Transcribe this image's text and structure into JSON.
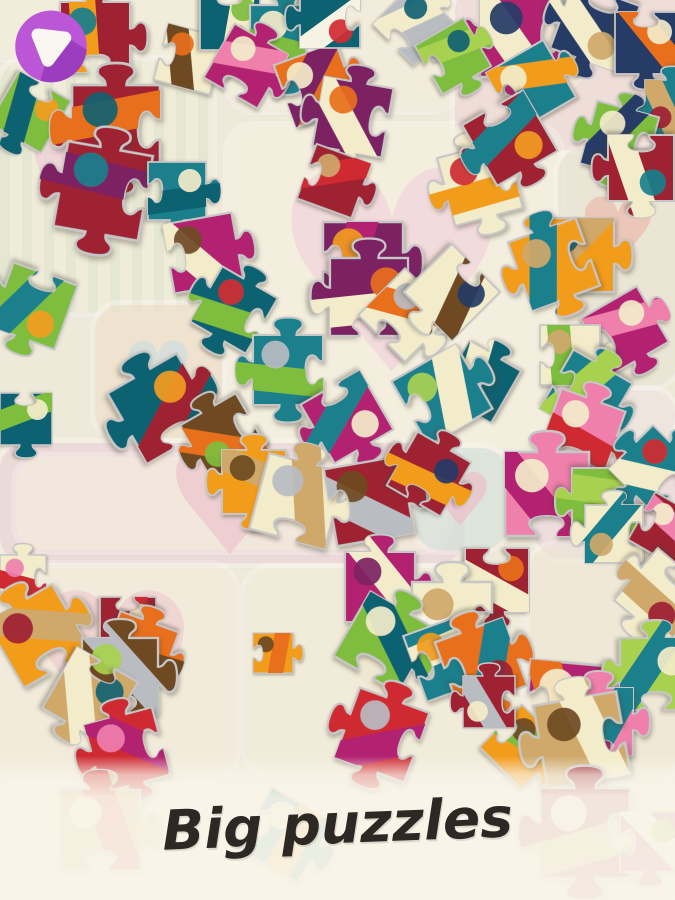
{
  "app": {
    "kind": "jigsaw-puzzle-game-screen"
  },
  "logo": {
    "name": "puzzle-app-logo",
    "glyph": "rounded-triangle-down",
    "circle_color": "#bb57d6",
    "shadow_color": "#9c3dc0",
    "glyph_color": "#faf7f2"
  },
  "banner": {
    "title": "Big puzzles",
    "bg_color": "#f9f5e9",
    "text_color": "#2d2823"
  },
  "scene": {
    "base_color": "#efe9da",
    "palette": {
      "teal": "#1a7f8c",
      "darkteal": "#116272",
      "magenta": "#b32470",
      "purple": "#7c2362",
      "darkred": "#9e2033",
      "red": "#cf2b32",
      "orange": "#f29c1f",
      "tangerine": "#e86f1a",
      "cream": "#f3ecca",
      "tan": "#cfa86a",
      "brown": "#6e4a23",
      "green": "#7ebd3d",
      "lime": "#a8d14f",
      "navy": "#253a66",
      "pink": "#ef7fab",
      "gray": "#b9bcc1",
      "white": "#f6f3e4"
    },
    "panels": [
      {
        "x": -20,
        "y": -20,
        "w": 260,
        "h": 78,
        "bg": "#f6efdc"
      },
      {
        "x": 0,
        "y": 60,
        "w": 212,
        "h": 252,
        "bg": "#f1f0da",
        "stripes": true,
        "hx": 78,
        "hy": 185,
        "hs": 120,
        "hc": "#f2c9d8"
      },
      {
        "x": 228,
        "y": -12,
        "w": 230,
        "h": 122,
        "bg": "#f5efdf"
      },
      {
        "x": 455,
        "y": -15,
        "w": 230,
        "h": 165,
        "bg": "#efd5d8",
        "hx": 560,
        "hy": 72,
        "hs": 120,
        "hc": "#f6efdd"
      },
      {
        "x": 228,
        "y": 126,
        "w": 332,
        "h": 322,
        "bg": "#f7f3e2",
        "hx": 392,
        "hy": 292,
        "hs": 280,
        "hc": "#f2d0dc"
      },
      {
        "x": 558,
        "y": 148,
        "w": 120,
        "h": 238,
        "bg": "#e8e2d1",
        "hx": 618,
        "hy": 238,
        "hs": 92,
        "hc": "#eab4a6"
      },
      {
        "x": 95,
        "y": 305,
        "w": 127,
        "h": 133,
        "bg": "#efdfc7",
        "hx": 158,
        "hy": 378,
        "hs": 82,
        "hc": "#cadde2"
      },
      {
        "x": 0,
        "y": 443,
        "w": 465,
        "h": 120,
        "bg": "#ebcfd9"
      },
      {
        "x": 16,
        "y": 457,
        "w": 432,
        "h": 93,
        "bg": "#f8f3e0",
        "hx": 230,
        "hy": 512,
        "hs": 150,
        "hc": "#edbfca"
      },
      {
        "x": 415,
        "y": 448,
        "w": 92,
        "h": 102,
        "bg": "#cfe2dc",
        "hx": 460,
        "hy": 505,
        "hs": 74,
        "hc": "#f0b9c6"
      },
      {
        "x": 535,
        "y": 436,
        "w": 140,
        "h": 122,
        "bg": "#ecd4de",
        "hx": 605,
        "hy": 502,
        "hs": 86,
        "hc": "#f6f2e6"
      },
      {
        "x": 558,
        "y": 390,
        "w": 117,
        "h": 50,
        "bg": "#f0e2e4"
      },
      {
        "x": -12,
        "y": 565,
        "w": 247,
        "h": 215,
        "bg": "#f6eedd",
        "hx": 112,
        "hy": 680,
        "hs": 200,
        "hc": "#eec9cf"
      },
      {
        "x": 245,
        "y": 568,
        "w": 275,
        "h": 205,
        "bg": "#f4eedb",
        "hx": 382,
        "hy": 672,
        "hs": 120,
        "hc": "#efe5cc"
      },
      {
        "x": 530,
        "y": 545,
        "w": 145,
        "h": 240,
        "bg": "#efe8d6"
      },
      {
        "x": 540,
        "y": 790,
        "w": 135,
        "h": 120,
        "bg": "#f0e0ce"
      }
    ],
    "pieces": {
      "fields": [
        "x",
        "y",
        "w",
        "rot",
        "template",
        "c1",
        "c2",
        "c3"
      ],
      "edge_color": "#c6c6c6",
      "items": [
        [
          60,
          2,
          70,
          0,
          1,
          "#9e2033",
          "#f29c1f",
          "#1a7f8c"
        ],
        [
          160,
          30,
          58,
          15,
          2,
          "#f3ecca",
          "#6e4a23",
          "#e86f1a"
        ],
        [
          200,
          -10,
          60,
          90,
          2,
          "#116272",
          "#f3ecca",
          "#7ebd3d"
        ],
        [
          250,
          5,
          72,
          0,
          3,
          "#1a7f8c",
          "#7ebd3d",
          "#f3ecca"
        ],
        [
          215,
          35,
          62,
          30,
          1,
          "#b32470",
          "#ef7fab",
          "#f3ecca"
        ],
        [
          283,
          52,
          66,
          -20,
          2,
          "#e86f1a",
          "#7c2362",
          "#f3ecca"
        ],
        [
          318,
          82,
          70,
          10,
          3,
          "#7c2362",
          "#f3ecca",
          "#e86f1a"
        ],
        [
          385,
          -5,
          58,
          45,
          1,
          "#b9bcc1",
          "#f3ecca",
          "#116272"
        ],
        [
          300,
          -12,
          60,
          180,
          2,
          "#116272",
          "#f6f3e4",
          "#cf2b32"
        ],
        [
          480,
          -5,
          82,
          0,
          3,
          "#b32470",
          "#f3ecca",
          "#253a66"
        ],
        [
          560,
          -8,
          70,
          200,
          1,
          "#253a66",
          "#f3ecca",
          "#cfa86a"
        ],
        [
          615,
          12,
          62,
          90,
          2,
          "#253a66",
          "#e86f1a",
          "#f3ecca"
        ],
        [
          645,
          80,
          55,
          270,
          1,
          "#1a7f8c",
          "#cfa86a",
          "#9e2033"
        ],
        [
          0,
          82,
          60,
          120,
          2,
          "#7ebd3d",
          "#116272",
          "#f29c1f"
        ],
        [
          72,
          85,
          88,
          0,
          3,
          "#9e2033",
          "#e86f1a",
          "#116272"
        ],
        [
          425,
          28,
          56,
          60,
          1,
          "#7ebd3d",
          "#a8d14f",
          "#116272"
        ],
        [
          498,
          52,
          66,
          -30,
          2,
          "#1a7f8c",
          "#f29c1f",
          "#f3ecca"
        ],
        [
          588,
          108,
          64,
          15,
          3,
          "#7ebd3d",
          "#253a66",
          "#f3ecca"
        ],
        [
          608,
          135,
          66,
          180,
          1,
          "#9e2033",
          "#f3ecca",
          "#1a7f8c"
        ],
        [
          305,
          152,
          58,
          20,
          2,
          "#9e2033",
          "#cf2b32",
          "#cfa86a"
        ],
        [
          445,
          148,
          70,
          -15,
          3,
          "#f3ecca",
          "#f29c1f",
          "#cf2b32"
        ],
        [
          475,
          103,
          70,
          150,
          1,
          "#9e2033",
          "#1a7f8c",
          "#f29c1f"
        ],
        [
          540,
          218,
          74,
          0,
          2,
          "#f29c1f",
          "#cfa86a",
          "#116272"
        ],
        [
          60,
          148,
          86,
          10,
          3,
          "#9e2033",
          "#7c2362",
          "#1a7f8c"
        ],
        [
          148,
          162,
          58,
          90,
          1,
          "#1a7f8c",
          "#116272",
          "#f3ecca"
        ],
        [
          168,
          218,
          70,
          -10,
          2,
          "#b32470",
          "#f3ecca",
          "#6e4a23"
        ],
        [
          202,
          278,
          64,
          30,
          3,
          "#116272",
          "#7ebd3d",
          "#cf2b32"
        ],
        [
          0,
          272,
          68,
          200,
          1,
          "#7ebd3d",
          "#1a7f8c",
          "#f29c1f"
        ],
        [
          323,
          222,
          80,
          0,
          2,
          "#7c2362",
          "#b32470",
          "#f29c1f"
        ],
        [
          330,
          258,
          78,
          90,
          3,
          "#7c2362",
          "#f3ecca",
          "#e86f1a"
        ],
        [
          372,
          282,
          66,
          45,
          1,
          "#f3ecca",
          "#e86f1a",
          "#b9bcc1"
        ],
        [
          418,
          258,
          68,
          135,
          2,
          "#f3ecca",
          "#6e4a23",
          "#253a66"
        ],
        [
          518,
          228,
          72,
          -20,
          3,
          "#f29c1f",
          "#1a7f8c",
          "#cfa86a"
        ],
        [
          593,
          298,
          64,
          60,
          1,
          "#b32470",
          "#ef7fab",
          "#f3ecca"
        ],
        [
          540,
          325,
          60,
          0,
          2,
          "#f3ecca",
          "#7ebd3d",
          "#cfa86a"
        ],
        [
          552,
          362,
          68,
          210,
          3,
          "#1a7f8c",
          "#a8d14f",
          "#f3ecca"
        ],
        [
          548,
          398,
          68,
          20,
          1,
          "#ef7fab",
          "#cf2b32",
          "#f3ecca"
        ],
        [
          450,
          352,
          60,
          300,
          2,
          "#116272",
          "#f3ecca",
          "#b32470"
        ],
        [
          253,
          335,
          70,
          0,
          3,
          "#1a7f8c",
          "#7ebd3d",
          "#b9bcc1"
        ],
        [
          313,
          383,
          68,
          150,
          1,
          "#b32470",
          "#1a7f8c",
          "#f3ecca"
        ],
        [
          405,
          358,
          74,
          -30,
          2,
          "#1a7f8c",
          "#f3ecca",
          "#a8d14f"
        ],
        [
          122,
          368,
          80,
          60,
          3,
          "#116272",
          "#9e2033",
          "#f29c1f"
        ],
        [
          192,
          405,
          64,
          240,
          1,
          "#6e4a23",
          "#e86f1a",
          "#7ebd3d"
        ],
        [
          0,
          393,
          52,
          90,
          2,
          "#116272",
          "#7ebd3d",
          "#f3ecca"
        ],
        [
          222,
          450,
          64,
          0,
          3,
          "#f29c1f",
          "#cfa86a",
          "#6e4a23"
        ],
        [
          258,
          462,
          78,
          15,
          1,
          "#f3ecca",
          "#cfa86a",
          "#b9bcc1"
        ],
        [
          330,
          462,
          78,
          -10,
          2,
          "#9e2033",
          "#b9bcc1",
          "#6e4a23"
        ],
        [
          398,
          443,
          62,
          120,
          3,
          "#9e2033",
          "#f29c1f",
          "#253a66"
        ],
        [
          505,
          452,
          84,
          0,
          1,
          "#ef7fab",
          "#b32470",
          "#f3ecca"
        ],
        [
          572,
          468,
          68,
          180,
          2,
          "#7ebd3d",
          "#a8d14f",
          "#1a7f8c"
        ],
        [
          622,
          438,
          62,
          45,
          3,
          "#1a7f8c",
          "#f3ecca",
          "#cf2b32"
        ],
        [
          585,
          505,
          58,
          270,
          1,
          "#f3ecca",
          "#1a7f8c",
          "#cfa86a"
        ],
        [
          638,
          502,
          55,
          30,
          2,
          "#9e2033",
          "#ef7fab",
          "#f3ecca"
        ],
        [
          0,
          555,
          46,
          0,
          3,
          "#f3ecca",
          "#cf2b32",
          "#ef7fab"
        ],
        [
          0,
          598,
          76,
          330,
          1,
          "#f29c1f",
          "#cfa86a",
          "#9e2033"
        ],
        [
          100,
          597,
          56,
          90,
          2,
          "#9e2033",
          "#cf2b32",
          "#f3ecca"
        ],
        [
          108,
          620,
          62,
          200,
          3,
          "#e86f1a",
          "#6e4a23",
          "#f29c1f"
        ],
        [
          82,
          638,
          76,
          0,
          1,
          "#6e4a23",
          "#b9bcc1",
          "#a8d14f"
        ],
        [
          55,
          660,
          70,
          120,
          2,
          "#cfa86a",
          "#f3ecca",
          "#116272"
        ],
        [
          92,
          715,
          70,
          -15,
          3,
          "#cf2b32",
          "#b32470",
          "#ef7fab"
        ],
        [
          345,
          552,
          70,
          0,
          1,
          "#b32470",
          "#f3ecca",
          "#7c2362"
        ],
        [
          465,
          548,
          64,
          90,
          2,
          "#9e2033",
          "#f3ecca",
          "#e86f1a"
        ],
        [
          412,
          582,
          80,
          0,
          3,
          "#f3ecca",
          "#f6f3e4",
          "#cfa86a"
        ],
        [
          347,
          605,
          74,
          30,
          1,
          "#7ebd3d",
          "#116272",
          "#f3ecca"
        ],
        [
          413,
          622,
          70,
          -20,
          2,
          "#1a7f8c",
          "#f3ecca",
          "#f29c1f"
        ],
        [
          445,
          628,
          72,
          160,
          3,
          "#e86f1a",
          "#1a7f8c",
          "#9e2033"
        ],
        [
          628,
          562,
          68,
          220,
          1,
          "#f3ecca",
          "#cfa86a",
          "#9e2033"
        ],
        [
          527,
          663,
          88,
          5,
          2,
          "#b32470",
          "#e86f1a",
          "#f3ecca"
        ],
        [
          620,
          638,
          72,
          90,
          3,
          "#a8d14f",
          "#1a7f8c",
          "#f3ecca"
        ],
        [
          565,
          688,
          68,
          0,
          1,
          "#ef7fab",
          "#1a7f8c",
          "#cfa86a"
        ],
        [
          492,
          717,
          60,
          45,
          2,
          "#f29c1f",
          "#7ebd3d",
          "#6e4a23"
        ],
        [
          540,
          698,
          84,
          -10,
          3,
          "#cfa86a",
          "#f3ecca",
          "#6e4a23"
        ],
        [
          463,
          676,
          52,
          270,
          1,
          "#9e2033",
          "#b9bcc1",
          "#f3ecca"
        ],
        [
          253,
          633,
          40,
          0,
          2,
          "#f29c1f",
          "#e86f1a",
          "#6e4a23"
        ],
        [
          345,
          698,
          74,
          20,
          3,
          "#cf2b32",
          "#b32470",
          "#b9bcc1"
        ],
        [
          60,
          790,
          80,
          0,
          1,
          "#cfa86a",
          "#cf2b32",
          "#f3ecca"
        ],
        [
          250,
          800,
          70,
          30,
          2,
          "#1a7f8c",
          "#f29c1f",
          "#f3ecca"
        ],
        [
          540,
          788,
          90,
          0,
          3,
          "#9e2033",
          "#cfa86a",
          "#f3ecca"
        ],
        [
          620,
          812,
          60,
          90,
          1,
          "#b32470",
          "#f3ecca",
          "#7ebd3d"
        ]
      ]
    }
  }
}
